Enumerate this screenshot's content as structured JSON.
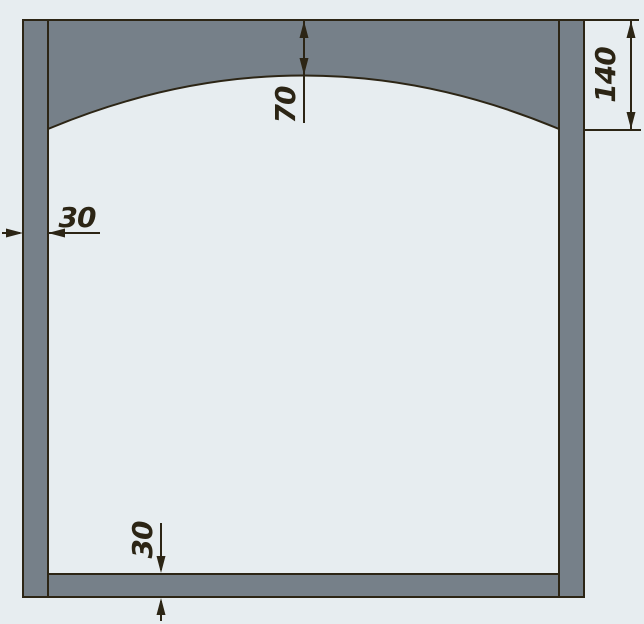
{
  "drawing": {
    "name": "arched-frame-cross-section",
    "colors": {
      "bg": "#e7edf0",
      "part-fill": "#768089",
      "ink": "#2c2515"
    },
    "dimensions": {
      "arch_rise": "70",
      "arch_side_depth": "140",
      "left_wall_thickness": "30",
      "bottom_wall_thickness": "30"
    }
  }
}
